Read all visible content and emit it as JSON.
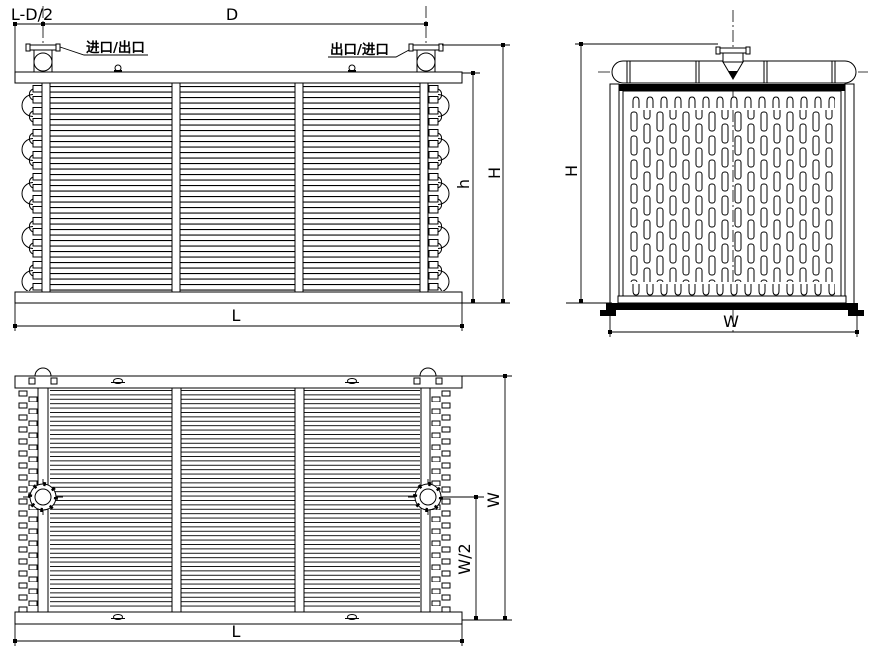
{
  "colors": {
    "background": "#ffffff",
    "line": "#000000"
  },
  "front_view": {
    "dim_left_offset": "L-D/2",
    "dim_nozzle_spacing": "D",
    "nozzle_left_label": "进口/出口",
    "nozzle_right_label": "出口/进口",
    "dim_core_height": "h",
    "dim_total_height": "H",
    "dim_length": "L"
  },
  "side_view": {
    "dim_total_height": "H",
    "dim_width": "W"
  },
  "plan_view": {
    "dim_width": "W",
    "dim_half_width": "W/2",
    "dim_length": "L"
  }
}
